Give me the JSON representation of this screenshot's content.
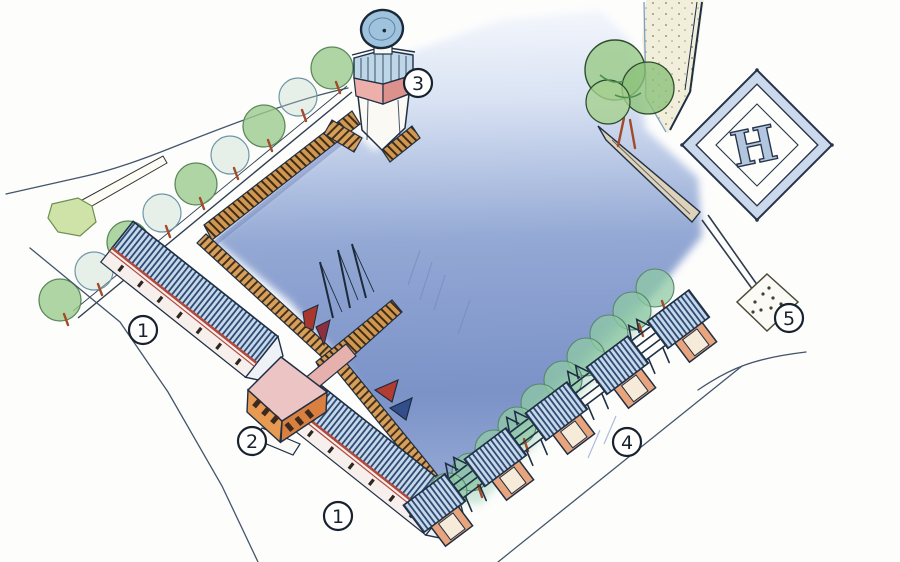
{
  "markers": [
    {
      "id": "north-shed",
      "number": "1"
    },
    {
      "id": "clubhouse",
      "number": "2"
    },
    {
      "id": "south-shed",
      "number": "1"
    },
    {
      "id": "signal-tower",
      "number": "3"
    },
    {
      "id": "pavilion-row",
      "number": "4"
    },
    {
      "id": "plaza",
      "number": "5"
    }
  ],
  "helipad": {
    "letter": "H"
  },
  "colors": {
    "water_deep": "#7e95ca",
    "water_light": "#eef3fa",
    "quay_tan": "#d6a05c",
    "roof_hatch_blue": "#2c4a72",
    "roof_base_blue": "#c6d8ea",
    "wall_orange": "#e89a52",
    "clubhouse_roof_pink": "#ecc4c4",
    "tower_band_pink": "#ecafa9",
    "tree_green": "#9ccb8d",
    "shore_tree_green": "#8fc9a4",
    "trunk_red": "#a34a28",
    "helipad_band": "#ccd8eb",
    "ink": "#1f2f44"
  }
}
